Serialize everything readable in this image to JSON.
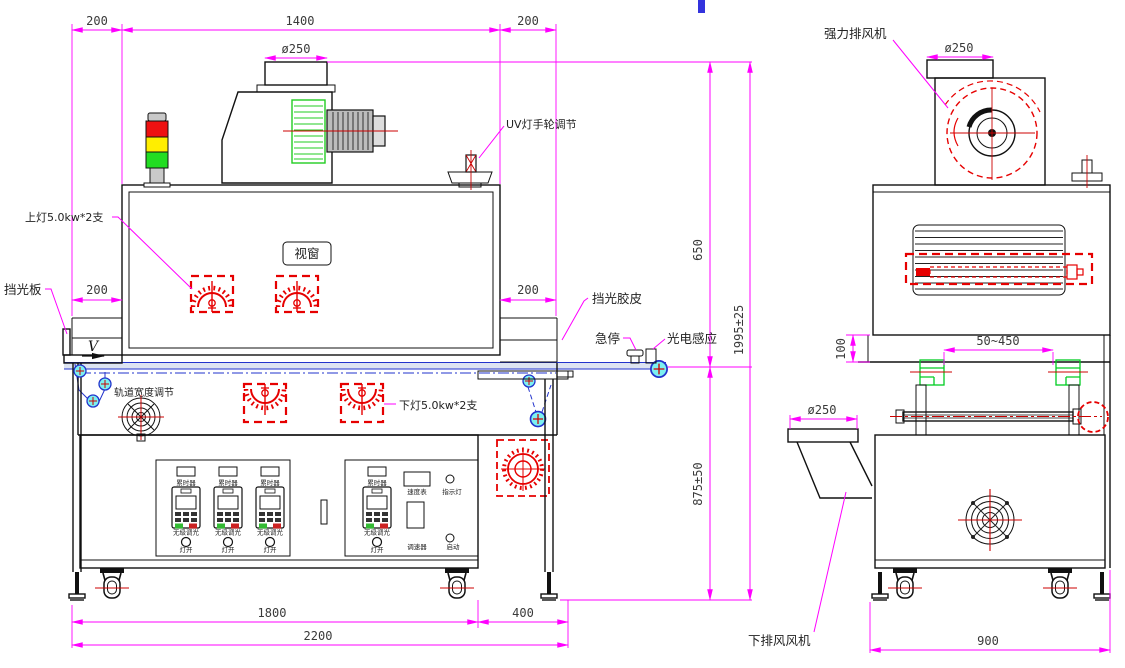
{
  "colors": {
    "dimension_magenta": "#ff00ff",
    "lamp_red": "#e60000",
    "belt_blue": "#2233cc",
    "roller_cyan": "#66eeee",
    "part_green": "#00cc22",
    "signal_red": "#ee1111",
    "signal_yellow": "#ffee00",
    "signal_green": "#22dd22"
  },
  "front_view": {
    "dimensions": {
      "top_left_200": "200",
      "top_width_1400": "1400",
      "top_right_200": "200",
      "top_duct_dia": "ø250",
      "left_tunnel_200": "200",
      "right_tunnel_200": "200",
      "height_650": "650",
      "height_total_1995": "1995±25",
      "height_belt_875": "875±50",
      "bottom_1800": "1800",
      "bottom_400": "400",
      "bottom_2200": "2200"
    },
    "labels": {
      "uv_lamp_handwheel": "UV灯手轮调节",
      "upper_lamp": "上灯5.0kw*2支",
      "light_shield_plate": "挡光板",
      "view_window": "视窗",
      "light_shield_rubber": "挡光胶皮",
      "emergency_stop": "急停",
      "photoelectric_sensor": "光电感应",
      "belt_direction": "V",
      "track_width_adjust": "轨道宽度调节",
      "lower_lamp": "下灯5.0kw*2支"
    },
    "left_panel": {
      "columns": [
        {
          "timer": "累时器",
          "dimming": "无级调光",
          "lamp_on": "灯开"
        },
        {
          "timer": "累时器",
          "dimming": "无级调光",
          "lamp_on": "灯开"
        },
        {
          "timer": "累时器",
          "dimming": "无级调光",
          "lamp_on": "灯开"
        }
      ]
    },
    "right_panel": {
      "timer": "累时器",
      "dimming": "无级调光",
      "lamp_on": "灯开",
      "speed_meter": "速度表",
      "indicator_light": "指示灯",
      "speed_controller": "调速器",
      "start": "启动"
    }
  },
  "side_view": {
    "labels": {
      "top_exhaust_fan": "强力排风机",
      "bottom_exhaust_fan": "下排风风机"
    },
    "dimensions": {
      "top_duct_dia": "ø250",
      "body_offset_100": "100",
      "track_range": "50~450",
      "lower_duct_dia": "ø250",
      "bottom_900": "900"
    }
  }
}
